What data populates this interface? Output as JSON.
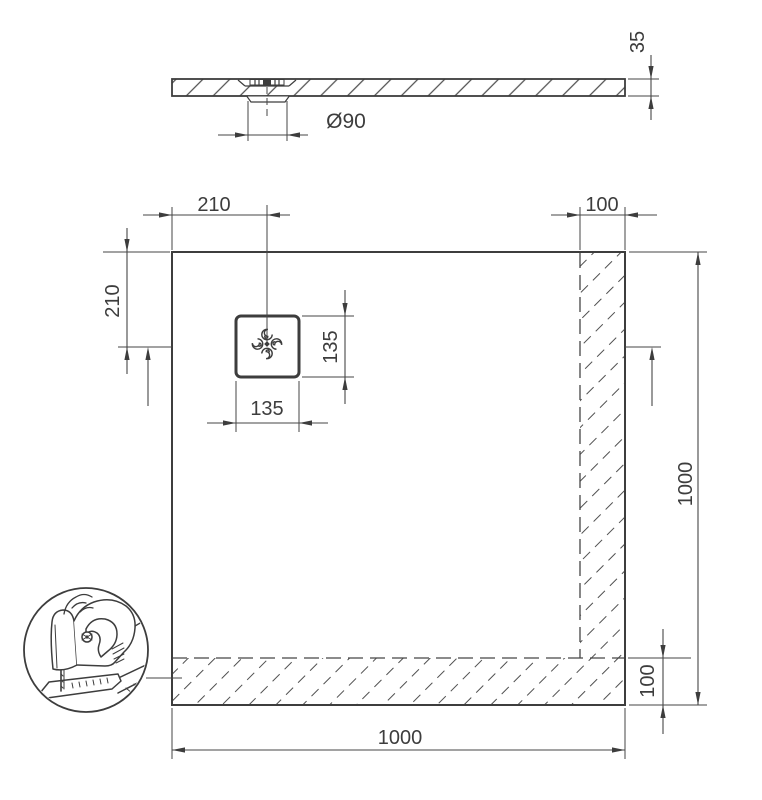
{
  "drawing": {
    "ink_color": "#3d3d3d",
    "hatch_color": "#505050",
    "side_view": {
      "thickness_label": "35",
      "drain_diameter_label": "Ø90"
    },
    "plan_view": {
      "drain_offset_top_label": "210",
      "right_cut_strip_label": "100",
      "drain_offset_left_label": "210",
      "drain_box_height_label": "135",
      "drain_box_width_label": "135",
      "overall_height_label": "1000",
      "bottom_cut_strip_label": "100",
      "overall_width_label": "1000"
    }
  }
}
